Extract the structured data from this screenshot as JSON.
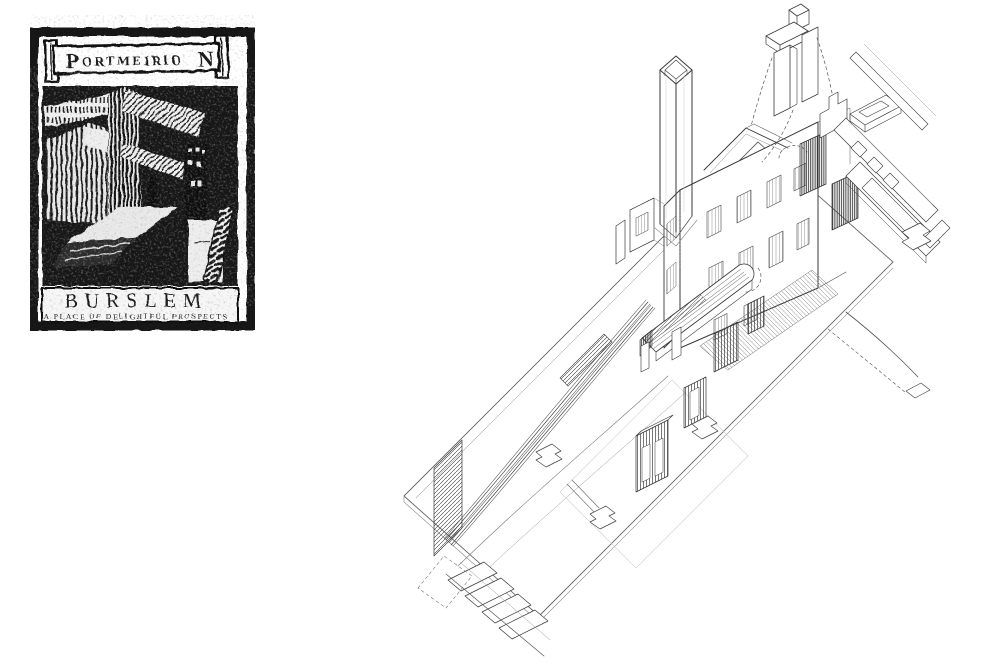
{
  "page": {
    "background_color": "#ffffff"
  },
  "stamp": {
    "banner": {
      "lead": "P",
      "middle": "ORTMEIRIO",
      "tail": "N"
    },
    "title": "BURSLEM",
    "subtitle": "A PLACE OF DELIGHTFUL PROSPECTS",
    "ink_color": "#1c1c1c",
    "paper_color": "#ffffff"
  },
  "drawing": {
    "line_color": "#3f3f3f",
    "components": [
      "ground-plane",
      "entry-steps",
      "curved-colonnade-wall",
      "shopfront-panels",
      "column-footings",
      "west-wing",
      "main-building",
      "gable-wall",
      "facade-windows",
      "apse-arch",
      "balcony-deck",
      "chimney",
      "exploded-chimney-cap",
      "gable-frames",
      "floor-frames",
      "hatched-stair",
      "curved-ramp"
    ]
  }
}
